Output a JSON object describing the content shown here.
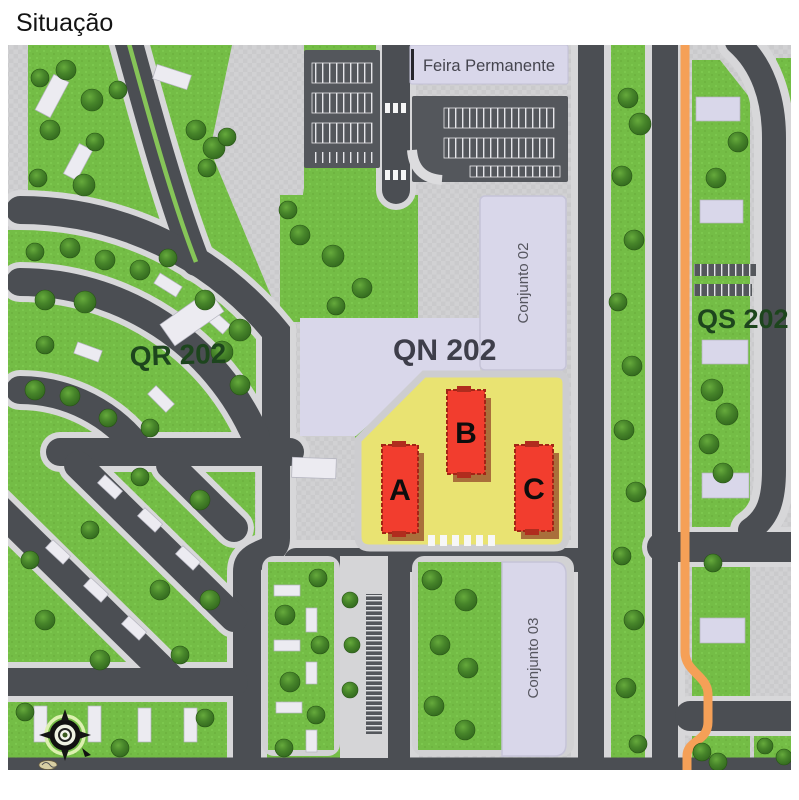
{
  "title": "Situação",
  "map": {
    "labels": {
      "feira_permanente": "Feira Permanente",
      "qr_202": "QR 202",
      "qn_202": "QN 202",
      "qs_202": "QS 202",
      "conjunto_02": "Conjunto 02",
      "conjunto_03": "Conjunto 03"
    },
    "towers": {
      "a": "A",
      "b": "B",
      "c": "C"
    },
    "colors": {
      "highlight_lot_yellow": "#e9e372",
      "tower_red": "#f23d2e",
      "route_orange": "#f5a057",
      "grass_green": "#74bd46",
      "road_gray": "#4b4e53",
      "building_lavender": "#d9d7ea",
      "label_dark_green": "#1d451d",
      "label_slate": "#3e3e4a"
    },
    "compass": "compass-rose-icon"
  }
}
